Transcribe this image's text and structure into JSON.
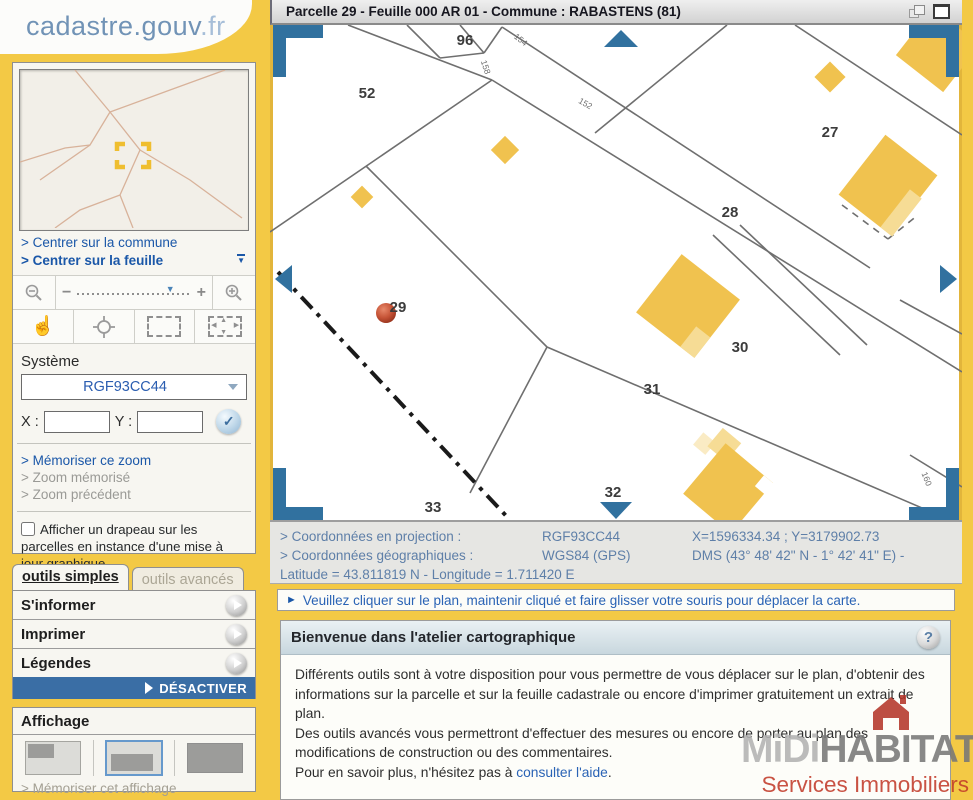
{
  "brand": {
    "logo_main": "cadastre.gouv",
    "logo_tld": ".fr"
  },
  "sidebar": {
    "links": {
      "center_commune": "> Centrer sur la commune",
      "center_feuille": "> Centrer sur la feuille"
    },
    "system": {
      "label": "Système",
      "value": "RGF93CC44"
    },
    "coords_inputs": {
      "x_label": "X :",
      "y_label": "Y :"
    },
    "memory_links": {
      "memorize": "> Mémoriser ce zoom",
      "memorized": "> Zoom mémorisé",
      "previous": "> Zoom précédent"
    },
    "flag_checkbox": "Afficher un drapeau sur les parcelles en instance d'une mise à jour graphique",
    "tabs": {
      "simple": "outils simples",
      "advanced": "outils avancés"
    },
    "tools": {
      "inform": "S'informer",
      "print": "Imprimer",
      "legends": "Légendes",
      "deactivate": "DÉSACTIVER"
    },
    "display": {
      "title": "Affichage",
      "memorize_display": "> Mémoriser cet affichage"
    }
  },
  "map": {
    "title": "Parcelle 29 - Feuille 000 AR 01 - Commune : RABASTENS (81)",
    "selected_parcel": "29",
    "parcel_labels": [
      {
        "text": "52",
        "x": 97,
        "y": 73
      },
      {
        "text": "96",
        "x": 195,
        "y": 20
      },
      {
        "text": "27",
        "x": 560,
        "y": 112
      },
      {
        "text": "28",
        "x": 460,
        "y": 192
      },
      {
        "text": "29",
        "x": 128,
        "y": 287
      },
      {
        "text": "30",
        "x": 470,
        "y": 327
      },
      {
        "text": "31",
        "x": 382,
        "y": 369
      },
      {
        "text": "32",
        "x": 343,
        "y": 472
      },
      {
        "text": "33",
        "x": 163,
        "y": 487
      }
    ],
    "small_labels": [
      {
        "text": "154",
        "x": 249,
        "y": 17,
        "rot": 38
      },
      {
        "text": "158",
        "x": 213,
        "y": 43,
        "rot": 72
      },
      {
        "text": "152",
        "x": 314,
        "y": 81,
        "rot": 30
      },
      {
        "text": "160",
        "x": 654,
        "y": 455,
        "rot": 68
      }
    ]
  },
  "coordinates": {
    "projection_label": "> Coordonnées en projection :",
    "projection_system": "RGF93CC44",
    "projection_values": "X=1596334.34 ; Y=3179902.73",
    "geographic_label": "> Coordonnées géographiques :",
    "geographic_system": "WGS84 (GPS)",
    "geographic_values": "DMS (43° 48' 42\" N - 1° 42' 41\" E) -",
    "lat_lon": "Latitude = 43.811819 N - Longitude = 1.711420 E"
  },
  "instruction": "Veuillez cliquer sur le plan, maintenir cliqué et faire glisser votre souris pour déplacer la carte.",
  "welcome": {
    "title": "Bienvenue dans l'atelier cartographique",
    "p1": "Différents outils sont à votre disposition pour vous permettre de vous déplacer sur le plan, d'obtenir des informations sur la parcelle et sur la feuille cadastrale ou encore d'imprimer gratuitement un extrait de plan.",
    "p2": "Des outils avancés vous permettront d'effectuer des mesures ou encore de porter au plan des modifications de construction ou des commentaires.",
    "p3_prefix": "Pour en savoir plus, n'hésitez pas à ",
    "p3_link": "consulter l'aide",
    "p3_suffix": "."
  },
  "watermark": {
    "name_light": "MiDi",
    "name_dark": "HABITAT",
    "tagline": "Services Immobiliers"
  },
  "colors": {
    "accent_yellow": "#F3C945",
    "link_blue": "#1A57A8",
    "action_blue": "#3A6EA5",
    "nav_arrow_blue": "#31719F",
    "building_yellow": "#F0C24F",
    "marker_red": "#B5442A"
  }
}
